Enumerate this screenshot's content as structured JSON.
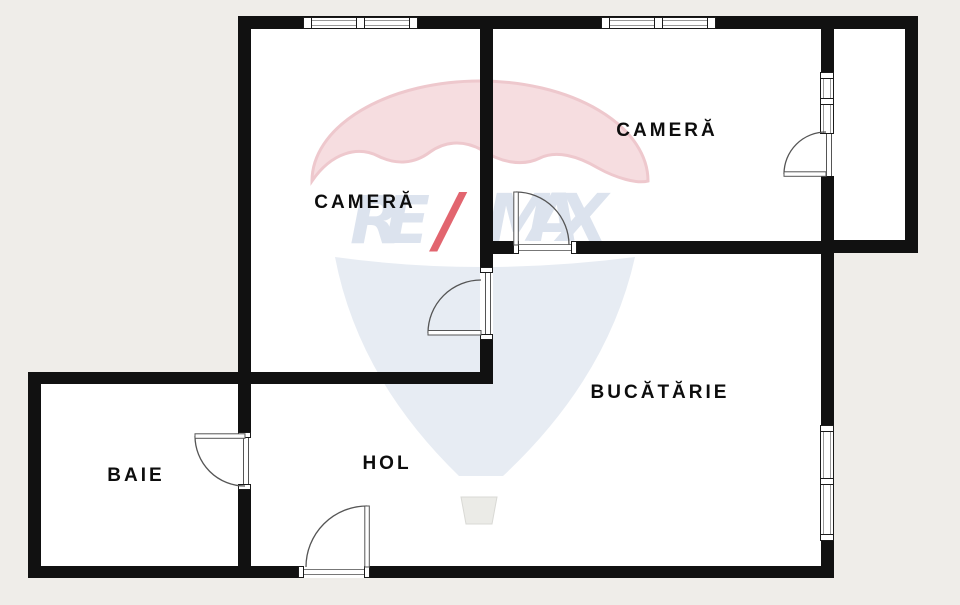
{
  "floor_plan": {
    "rooms": [
      {
        "id": "camera-left",
        "label": "CAMERĂ"
      },
      {
        "id": "camera-right",
        "label": "CAMERĂ"
      },
      {
        "id": "bucatarie",
        "label": "BUCĂTĂRIE"
      },
      {
        "id": "baie",
        "label": "BAIE"
      },
      {
        "id": "hol",
        "label": "HOL"
      }
    ],
    "watermark": {
      "re": "RE",
      "slash": "/",
      "max": "MAX"
    },
    "colors": {
      "background": "#efede9",
      "wall": "#111111",
      "room_fill": "#ffffff",
      "door_arc": "#555555",
      "watermark_pink": "#f6dde0",
      "watermark_pink_edge": "#eec8cd",
      "watermark_blue": "#e7ecf3",
      "watermark_text": "#dce3ee",
      "watermark_red": "#e2656f",
      "watermark_basket": "#ebebe7"
    }
  }
}
